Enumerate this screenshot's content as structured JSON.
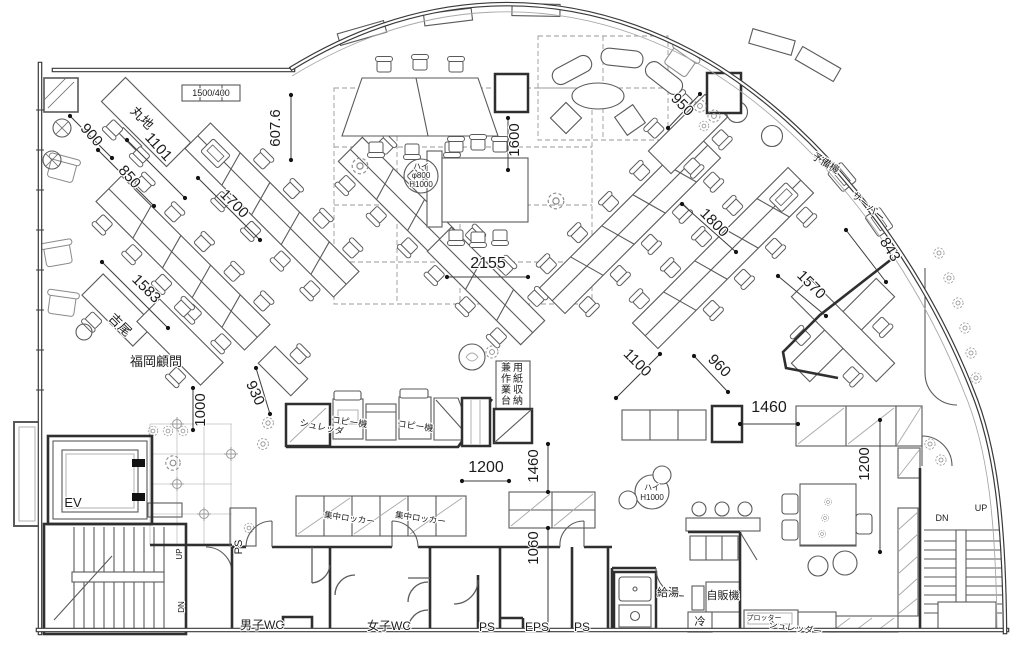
{
  "floorplan": {
    "description": "Office floor plan with curved curtain wall, angled desk clusters, meeting areas, core with elevator, stairs and WC block",
    "colors": {
      "background": "#ffffff",
      "wall": "#3a3a3a",
      "furniture": "#5a5a5a",
      "light": "#a8a8a8",
      "dashed": "#9a9a9a",
      "dimension": "#3c3c3c",
      "text": "#1c1c1c"
    },
    "labels": [
      {
        "name": "dim-900",
        "text": "900",
        "x": 88,
        "y": 138,
        "rot": 48,
        "size": 15
      },
      {
        "name": "dim-850",
        "text": "850",
        "x": 126,
        "y": 180,
        "rot": 48,
        "size": 15
      },
      {
        "name": "dim-1101",
        "text": "1101",
        "x": 155,
        "y": 150,
        "rot": 48,
        "size": 15
      },
      {
        "name": "desk-group-label-maruchi",
        "text": "丸地",
        "x": 139,
        "y": 121,
        "rot": 45,
        "size": 13
      },
      {
        "name": "note-window-1500-400",
        "text": "1500/400",
        "x": 211,
        "y": 96,
        "rot": 0,
        "size": 9
      },
      {
        "name": "dim-607-6",
        "text": "607.6",
        "x": 280,
        "y": 128,
        "rot": -90,
        "size": 15
      },
      {
        "name": "dim-1600",
        "text": "1600",
        "x": 519,
        "y": 140,
        "rot": -90,
        "size": 15
      },
      {
        "name": "dim-950",
        "text": "950",
        "x": 679,
        "y": 108,
        "rot": 45,
        "size": 15
      },
      {
        "name": "dim-1800",
        "text": "1800",
        "x": 711,
        "y": 226,
        "rot": 45,
        "size": 15
      },
      {
        "name": "label-spare-machine",
        "text": "予備機",
        "x": 824,
        "y": 166,
        "rot": 32,
        "size": 10
      },
      {
        "name": "label-server",
        "text": "サーバー",
        "x": 866,
        "y": 209,
        "rot": 40,
        "size": 10
      },
      {
        "name": "dim-843",
        "text": "843",
        "x": 886,
        "y": 252,
        "rot": 58,
        "size": 15
      },
      {
        "name": "dim-1700",
        "text": "1700",
        "x": 231,
        "y": 207,
        "rot": 45,
        "size": 15
      },
      {
        "name": "dim-2155",
        "text": "2155",
        "x": 488,
        "y": 268,
        "rot": 0,
        "size": 16
      },
      {
        "name": "dim-1583",
        "text": "1583",
        "x": 143,
        "y": 292,
        "rot": 45,
        "size": 15
      },
      {
        "name": "desk-group-label-yoshio",
        "text": "吉尾",
        "x": 117,
        "y": 328,
        "rot": 45,
        "size": 13
      },
      {
        "name": "desk-group-label-fukuoka-advisor",
        "text": "福岡顧問",
        "x": 156,
        "y": 366,
        "rot": 0,
        "size": 13
      },
      {
        "name": "dim-1570",
        "text": "1570",
        "x": 808,
        "y": 288,
        "rot": 45,
        "size": 15
      },
      {
        "name": "dim-1100",
        "text": "1100",
        "x": 634,
        "y": 366,
        "rot": 45,
        "size": 15
      },
      {
        "name": "dim-960",
        "text": "960",
        "x": 716,
        "y": 369,
        "rot": 45,
        "size": 15
      },
      {
        "name": "dim-930",
        "text": "930",
        "x": 251,
        "y": 395,
        "rot": 65,
        "size": 15
      },
      {
        "name": "dim-1000",
        "text": "1000",
        "x": 205,
        "y": 410,
        "rot": -90,
        "size": 15
      },
      {
        "name": "dim-1460-upper",
        "text": "1460",
        "x": 769,
        "y": 412,
        "rot": 0,
        "size": 16
      },
      {
        "name": "dim-1200-right",
        "text": "1200",
        "x": 869,
        "y": 464,
        "rot": -90,
        "size": 15
      },
      {
        "name": "dim-1200-lower",
        "text": "1200",
        "x": 486,
        "y": 472,
        "rot": 0,
        "size": 16
      },
      {
        "name": "dim-1460-lower",
        "text": "1460",
        "x": 538,
        "y": 466,
        "rot": -90,
        "size": 15
      },
      {
        "name": "dim-1060",
        "text": "1060",
        "x": 538,
        "y": 548,
        "rot": -90,
        "size": 15
      },
      {
        "name": "label-shredder",
        "text": "シュレッダ",
        "x": 321,
        "y": 430,
        "rot": 12,
        "size": 9
      },
      {
        "name": "label-copier-1",
        "text": "コピー機",
        "x": 349,
        "y": 425,
        "rot": 8,
        "size": 9
      },
      {
        "name": "label-copier-2",
        "text": "コピー機",
        "x": 415,
        "y": 429,
        "rot": 8,
        "size": 9
      },
      {
        "name": "label-central-locker-1",
        "text": "集中ロッカー",
        "x": 349,
        "y": 521,
        "rot": 8,
        "size": 8.5
      },
      {
        "name": "label-central-locker-2",
        "text": "集中ロッカー",
        "x": 420,
        "y": 521,
        "rot": 8,
        "size": 8.5
      },
      {
        "name": "label-high-table-800-line1",
        "text": "ハイ",
        "x": 421,
        "y": 169,
        "rot": 0,
        "size": 8
      },
      {
        "name": "label-high-table-800-line2",
        "text": "φ800",
        "x": 421,
        "y": 178,
        "rot": 0,
        "size": 8
      },
      {
        "name": "label-high-table-800-line3",
        "text": "H1000",
        "x": 421,
        "y": 187,
        "rot": 0,
        "size": 8
      },
      {
        "name": "label-high-table-1000-line1",
        "text": "ハイ",
        "x": 652,
        "y": 490,
        "rot": 0,
        "size": 8
      },
      {
        "name": "label-high-table-1000-line2",
        "text": "H1000",
        "x": 652,
        "y": 500,
        "rot": 0,
        "size": 8
      },
      {
        "name": "label-paper-storage-col-right",
        "text": "用紙収納",
        "x": 518,
        "y": 371,
        "rot": 0,
        "size": 10,
        "vertical": true
      },
      {
        "name": "label-paper-storage-col-left",
        "text": "兼作業台",
        "x": 506,
        "y": 371,
        "rot": 0,
        "size": 10,
        "vertical": true
      },
      {
        "name": "room-elevator",
        "text": "EV",
        "x": 73,
        "y": 507,
        "rot": 0,
        "size": 13
      },
      {
        "name": "label-stairs-up-left",
        "text": "UP",
        "x": 182,
        "y": 554,
        "rot": -90,
        "size": 8
      },
      {
        "name": "label-stairs-dn-left",
        "text": "DN",
        "x": 184,
        "y": 607,
        "rot": -90,
        "size": 8
      },
      {
        "name": "label-ps-shaft",
        "text": "PS",
        "x": 242,
        "y": 547,
        "rot": -90,
        "size": 11
      },
      {
        "name": "room-mens-wc",
        "text": "男子WC",
        "x": 262,
        "y": 629,
        "rot": 0,
        "size": 12
      },
      {
        "name": "room-womens-wc",
        "text": "女子WC",
        "x": 389,
        "y": 630,
        "rot": 0,
        "size": 12
      },
      {
        "name": "room-ps-1",
        "text": "PS",
        "x": 487,
        "y": 631,
        "rot": 0,
        "size": 12
      },
      {
        "name": "room-eps",
        "text": "EPS",
        "x": 537,
        "y": 631,
        "rot": 0,
        "size": 12
      },
      {
        "name": "room-ps-2",
        "text": "PS",
        "x": 582,
        "y": 631,
        "rot": 0,
        "size": 12
      },
      {
        "name": "label-hot-water",
        "text": "給湯",
        "x": 668,
        "y": 596,
        "rot": 0,
        "size": 11
      },
      {
        "name": "label-vending-machine",
        "text": "自販機",
        "x": 723,
        "y": 599,
        "rot": 0,
        "size": 11
      },
      {
        "name": "label-refrigerator",
        "text": "冷",
        "x": 700,
        "y": 625,
        "rot": 0,
        "size": 11
      },
      {
        "name": "label-plotter",
        "text": "プロッター",
        "x": 764,
        "y": 620,
        "rot": 0,
        "size": 7
      },
      {
        "name": "label-shredder-2",
        "text": "シュレッダー",
        "x": 795,
        "y": 631,
        "rot": 8,
        "size": 9
      },
      {
        "name": "label-stairs-dn-right",
        "text": "DN",
        "x": 942,
        "y": 521,
        "rot": 0,
        "size": 9
      },
      {
        "name": "label-stairs-up-right",
        "text": "UP",
        "x": 981,
        "y": 511,
        "rot": 0,
        "size": 9
      }
    ]
  }
}
